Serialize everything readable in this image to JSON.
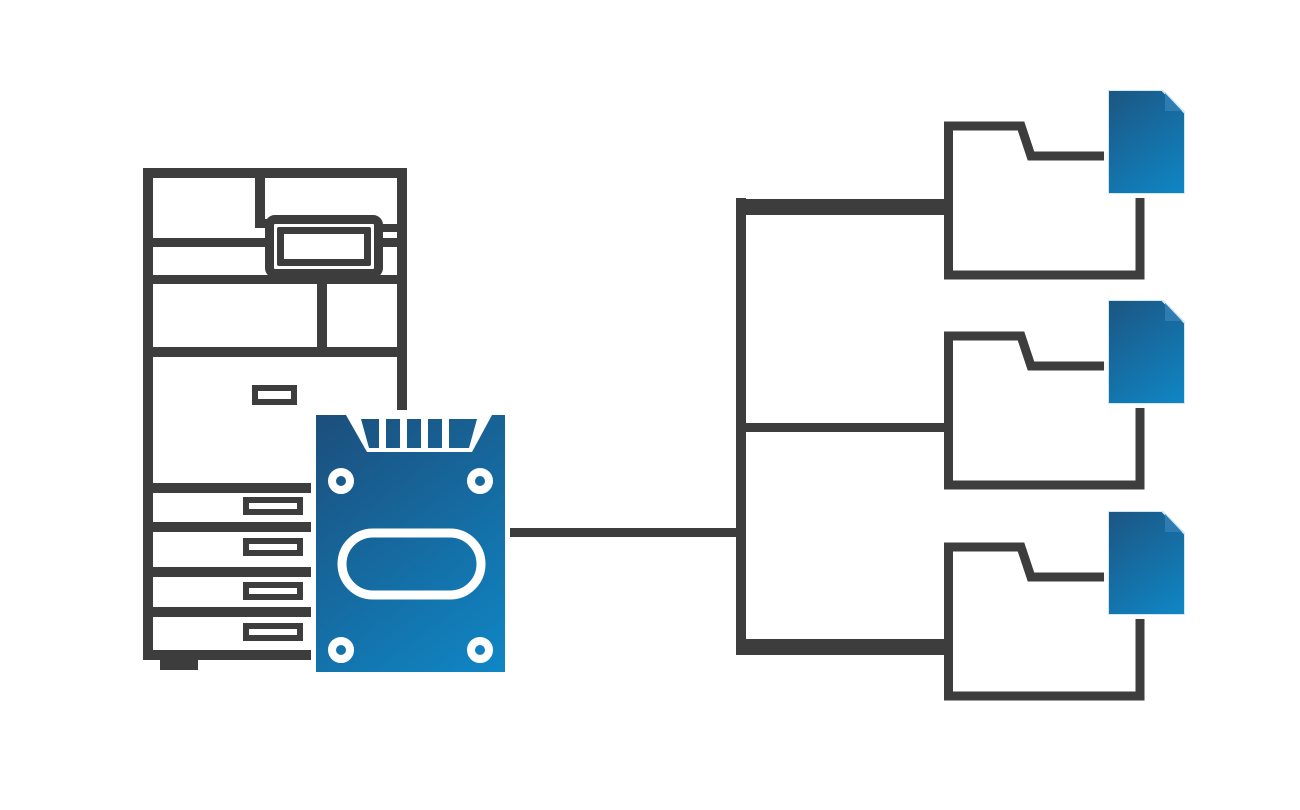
{
  "canvas": {
    "width": 1300,
    "height": 810,
    "background": "#ffffff"
  },
  "palette": {
    "outline": "#3d3d3d",
    "blue_gradient_start": "#1c4e7b",
    "blue_gradient_end": "#0f87c6",
    "fold_blue": "#2e7cb2",
    "document_edge": "#cfe8f5",
    "white": "#ffffff"
  },
  "nodes": {
    "printer": {
      "label": "multifunction printer"
    },
    "hard_drive": {
      "label": "printer hard disk drive"
    },
    "groups": [
      {
        "folder": {
          "label": "destination folder 1"
        },
        "document": {
          "label": "stored document 1"
        }
      },
      {
        "folder": {
          "label": "destination folder 2"
        },
        "document": {
          "label": "stored document 2"
        }
      },
      {
        "folder": {
          "label": "destination folder 3"
        },
        "document": {
          "label": "stored document 3"
        }
      }
    ]
  },
  "connections": [
    {
      "from": "hard_drive",
      "to": "folder-1",
      "style": "elbow"
    },
    {
      "from": "hard_drive",
      "to": "folder-2",
      "style": "elbow"
    },
    {
      "from": "hard_drive",
      "to": "folder-3",
      "style": "elbow"
    }
  ]
}
